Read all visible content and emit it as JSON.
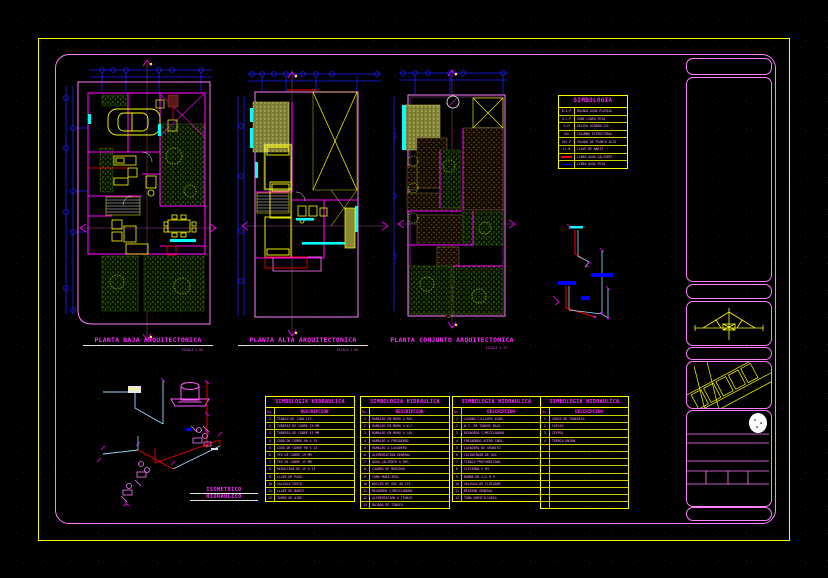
{
  "plans": [
    {
      "title": "PLANTA BAJA ARQUITECTONICA",
      "scale": "ESCALA 1:50"
    },
    {
      "title": "PLANTA ALTA ARQUITECTONICA",
      "scale": "ESCALA 1:50"
    },
    {
      "title": "PLANTA CONJUNTO ARQUITECTONICA",
      "scale": "ESCALA 1:75"
    }
  ],
  "isometric": {
    "line1": "ISOMETRICO",
    "line2": "HIDRAULICO"
  },
  "symbology": {
    "title": "SIMBOLOGIA",
    "rows": [
      {
        "abbr": "B.A.P",
        "desc": "BAJADA AGUA PLUVIAL",
        "swatch": ""
      },
      {
        "abbr": "S.L.F",
        "desc": "SUBE LINEA FRIA",
        "swatch": ""
      },
      {
        "abbr": "S-H",
        "desc": "SALIDA HIDRAULICA",
        "swatch": ""
      },
      {
        "abbr": "COL",
        "desc": "COLUMNA ESTRUCTURAL",
        "swatch": ""
      },
      {
        "abbr": "Vol.P",
        "desc": "VOLADO DE PLANTA ALTA",
        "swatch": ""
      },
      {
        "abbr": "Ll.N",
        "desc": "LLAVE DE NARIZ",
        "swatch": ""
      },
      {
        "abbr": "",
        "desc": "LINEA AGUA CALIENTE",
        "swatch": "#ff0000"
      },
      {
        "abbr": "",
        "desc": "LINEA AGUA FRIA",
        "swatch": "#0000ff"
      }
    ]
  },
  "hydraulic_tables": [
    {
      "title": "SIMBOLOGIA HIDRAULICA",
      "col_no": "No.",
      "col_desc": "DESCRIPCION",
      "rows": [
        {
          "no": "1",
          "desc": "TINACO DE 1100 LTS."
        },
        {
          "no": "2",
          "desc": "TUBERIA DE COBRE 19 MM"
        },
        {
          "no": "3",
          "desc": "TUBERIA DE COBRE 13 MM"
        },
        {
          "no": "4",
          "desc": "CODO DE COBRE 90 X 19"
        },
        {
          "no": "5",
          "desc": "CODO DE COBRE 90 X 13"
        },
        {
          "no": "6",
          "desc": "TEE DE COBRE 19 MM"
        },
        {
          "no": "7",
          "desc": "TEE DE COBRE 13 MM"
        },
        {
          "no": "8",
          "desc": "REDUCCION DE 19 A 13"
        },
        {
          "no": "9",
          "desc": "LLAVE DE PASO"
        },
        {
          "no": "10",
          "desc": "VALVULA CHECK"
        },
        {
          "no": "11",
          "desc": "LLAVE DE NARIZ"
        },
        {
          "no": "12",
          "desc": "JARRO DE AIRE"
        }
      ]
    },
    {
      "title": "SIMBOLOGIA HIDRAULICA",
      "col_no": "No.",
      "col_desc": "DESCRIPCION",
      "rows": [
        {
          "no": "1",
          "desc": "RAMALEO EN MURO A REG."
        },
        {
          "no": "2",
          "desc": "RAMALEO EN MURO A W.C."
        },
        {
          "no": "3",
          "desc": "RAMALEO EN MURO A LAV."
        },
        {
          "no": "4",
          "desc": "RAMALEO A FREGADERO"
        },
        {
          "no": "5",
          "desc": "RAMALEO A LAVADERO"
        },
        {
          "no": "6",
          "desc": "ALIMENTACION GENERAL"
        },
        {
          "no": "7",
          "desc": "AGUA CALIENTE A REG."
        },
        {
          "no": "8",
          "desc": "CUADRO DE MEDIDOR"
        },
        {
          "no": "9",
          "desc": "TOMA MUNICIPAL"
        },
        {
          "no": "10",
          "desc": "BOILER DE GAS 40 LTS."
        },
        {
          "no": "11",
          "desc": "REGADERA C/MEZCLADORA"
        },
        {
          "no": "12",
          "desc": "ALIMENTACION A TINACO"
        },
        {
          "no": "13",
          "desc": "BAJADA DE TINACO"
        }
      ]
    },
    {
      "title": "SIMBOLOGIA HIDRAULICA",
      "col_no": "No.",
      "col_desc": "DESCRIPCION",
      "rows": [
        {
          "no": "1",
          "desc": "LAVABO C/LLAVES ECON."
        },
        {
          "no": "2",
          "desc": "W.C. DE TANQUE BAJO"
        },
        {
          "no": "3",
          "desc": "REGADERA C/MEZCLADORA"
        },
        {
          "no": "4",
          "desc": "FREGADERO ACERO INOX."
        },
        {
          "no": "5",
          "desc": "LAVADERO DE GRANITO"
        },
        {
          "no": "6",
          "desc": "CALENTADOR DE GAS"
        },
        {
          "no": "7",
          "desc": "TINACO PREFABRICADO"
        },
        {
          "no": "8",
          "desc": "CISTERNA 5 M3"
        },
        {
          "no": "9",
          "desc": "BOMBA DE 1/2 H.P."
        },
        {
          "no": "10",
          "desc": "VALVULA DE FLOTADOR"
        },
        {
          "no": "11",
          "desc": "MEDIDOR GENERAL"
        },
        {
          "no": "12",
          "desc": "TOMA DOMICILIARIA"
        }
      ]
    },
    {
      "title": "SIMBOLOGIA HIDRAULICA",
      "col_no": "No.",
      "col_desc": "DESCRIPCION",
      "rows": [
        {
          "no": "1",
          "desc": "CRUCE DE TUBERIAS"
        },
        {
          "no": "2",
          "desc": "COFLEX"
        },
        {
          "no": "3",
          "desc": "CESPOL"
        },
        {
          "no": "4",
          "desc": "TUERCA UNION"
        },
        {
          "no": "",
          "desc": ""
        },
        {
          "no": "",
          "desc": ""
        },
        {
          "no": "",
          "desc": ""
        },
        {
          "no": "",
          "desc": ""
        },
        {
          "no": "",
          "desc": ""
        },
        {
          "no": "",
          "desc": ""
        },
        {
          "no": "",
          "desc": ""
        },
        {
          "no": "",
          "desc": ""
        },
        {
          "no": "",
          "desc": ""
        }
      ]
    }
  ],
  "colors": {
    "frame_yellow": "#ffff00",
    "sheet_magenta": "#ff7dff",
    "title_magenta": "#ff2bff",
    "dimension_blue": "#1c1cff",
    "accent_cyan": "#00ffff",
    "hot_water_red": "#ff0000",
    "cold_water_blue": "#0000ff",
    "grass_green": "#6fae00",
    "roof_brown": "#9a6a2a"
  }
}
